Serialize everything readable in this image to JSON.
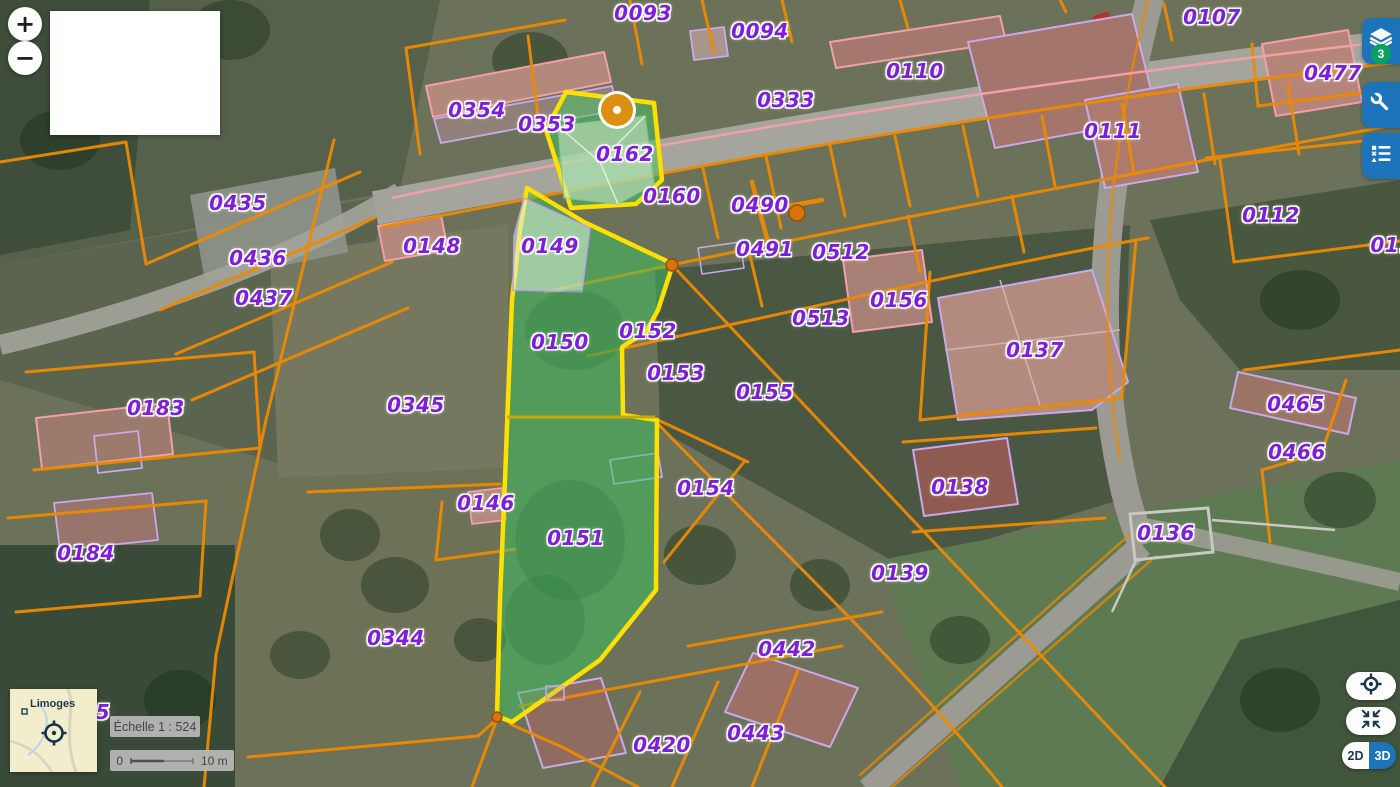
{
  "ui": {
    "zoom_in_label": "+",
    "zoom_out_label": "−",
    "layers_badge": "3",
    "mode_2d": "2D",
    "mode_3d": "3D"
  },
  "minimap": {
    "city_label": "Limoges"
  },
  "scale": {
    "echelle_text": "Échelle 1 : 524",
    "bar_min": "0",
    "bar_max": "10 m"
  },
  "map": {
    "colors": {
      "parcel_label_purple": "#7d1fd6",
      "parcel_line_orange": "#ee8a00",
      "selection_yellow": "#ffe000",
      "selection_green_fill": "rgba(58,196,94,0.5)",
      "toolbar_blue": "#1d74b8",
      "badge_green": "#0ca05e"
    },
    "parcels": [
      {
        "id": "0093",
        "x": 643,
        "y": 13
      },
      {
        "id": "0094",
        "x": 760,
        "y": 31
      },
      {
        "id": "0110",
        "x": 915,
        "y": 71
      },
      {
        "id": "0107",
        "x": 1212,
        "y": 17
      },
      {
        "id": "0477",
        "x": 1333,
        "y": 73
      },
      {
        "id": "0333",
        "x": 786,
        "y": 100
      },
      {
        "id": "0111",
        "x": 1113,
        "y": 131
      },
      {
        "id": "0354",
        "x": 477,
        "y": 110
      },
      {
        "id": "0353",
        "x": 547,
        "y": 124
      },
      {
        "id": "0162",
        "x": 625,
        "y": 154
      },
      {
        "id": "0160",
        "x": 672,
        "y": 196
      },
      {
        "id": "0490",
        "x": 760,
        "y": 205
      },
      {
        "id": "0112",
        "x": 1271,
        "y": 215
      },
      {
        "id": "0491",
        "x": 765,
        "y": 249
      },
      {
        "id": "0512",
        "x": 841,
        "y": 252
      },
      {
        "id": "011",
        "x": 1392,
        "y": 245
      },
      {
        "id": "0435",
        "x": 238,
        "y": 203
      },
      {
        "id": "0148",
        "x": 432,
        "y": 246
      },
      {
        "id": "0149",
        "x": 550,
        "y": 246
      },
      {
        "id": "0436",
        "x": 258,
        "y": 258
      },
      {
        "id": "0437",
        "x": 264,
        "y": 298
      },
      {
        "id": "0156",
        "x": 899,
        "y": 300
      },
      {
        "id": "0513",
        "x": 821,
        "y": 318
      },
      {
        "id": "0137",
        "x": 1035,
        "y": 350
      },
      {
        "id": "0152",
        "x": 648,
        "y": 331
      },
      {
        "id": "0150",
        "x": 560,
        "y": 342
      },
      {
        "id": "0153",
        "x": 676,
        "y": 373
      },
      {
        "id": "0155",
        "x": 765,
        "y": 392
      },
      {
        "id": "0465",
        "x": 1296,
        "y": 404
      },
      {
        "id": "0466",
        "x": 1297,
        "y": 452
      },
      {
        "id": "0183",
        "x": 156,
        "y": 408
      },
      {
        "id": "0345",
        "x": 416,
        "y": 405
      },
      {
        "id": "0154",
        "x": 706,
        "y": 488
      },
      {
        "id": "0138",
        "x": 960,
        "y": 487
      },
      {
        "id": "0146",
        "x": 486,
        "y": 503
      },
      {
        "id": "0151",
        "x": 576,
        "y": 538
      },
      {
        "id": "0136",
        "x": 1166,
        "y": 533
      },
      {
        "id": "0184",
        "x": 86,
        "y": 553
      },
      {
        "id": "0139",
        "x": 900,
        "y": 573
      },
      {
        "id": "0344",
        "x": 396,
        "y": 638
      },
      {
        "id": "0442",
        "x": 787,
        "y": 649
      },
      {
        "id": "0443",
        "x": 756,
        "y": 733
      },
      {
        "id": "0420",
        "x": 662,
        "y": 745
      },
      {
        "id": "5",
        "x": 103,
        "y": 712
      }
    ],
    "vertex_markers": [
      {
        "x": 617,
        "y": 110,
        "kind": "selected-point",
        "r": 16
      },
      {
        "x": 797,
        "y": 213,
        "kind": "point",
        "r": 8
      },
      {
        "x": 672,
        "y": 265,
        "kind": "point",
        "r": 6
      },
      {
        "x": 497,
        "y": 717,
        "kind": "point",
        "r": 5
      }
    ]
  }
}
